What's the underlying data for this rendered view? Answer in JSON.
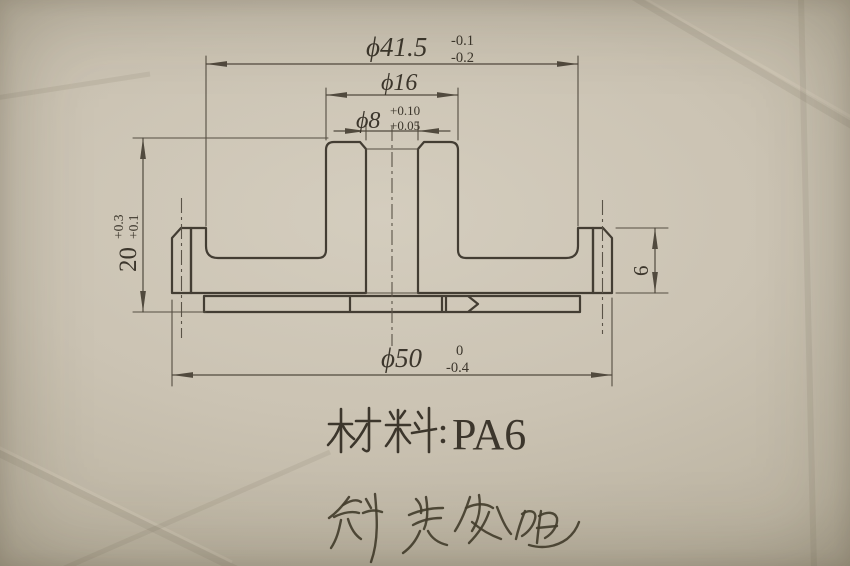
{
  "drawing": {
    "type": "engineering-section-drawing",
    "dims": {
      "dia41_5": {
        "label": "ϕ41.5",
        "tol_up": "-0.1",
        "tol_low": "-0.2"
      },
      "dia16": {
        "label": "ϕ16"
      },
      "dia8": {
        "label": "ϕ8",
        "tol_up": "+0.10",
        "tol_low": "+0.05"
      },
      "height20": {
        "label": "20",
        "tol_up": "+0.3",
        "tol_low": "+0.1"
      },
      "rim6": {
        "label": "6"
      },
      "dia50": {
        "label": "ϕ50",
        "tol_up": "0",
        "tol_low": "-0.4"
      }
    },
    "material_note": {
      "prefix": "材料：",
      "value": "PA6",
      "full": "材料：PA6"
    },
    "handwritten_note": {
      "text": "斜齿轮组"
    },
    "colors": {
      "line": "#433d33",
      "paper": "#cbc3b3"
    }
  }
}
